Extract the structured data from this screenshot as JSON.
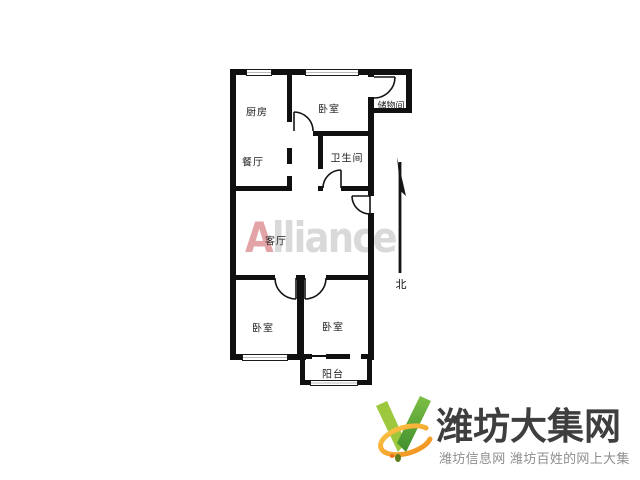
{
  "watermark": {
    "first_letter": "A",
    "rest": "lliance",
    "first_color": "#e3a4a8",
    "rest_color": "#d9d9d9"
  },
  "floorplan": {
    "wall_color": "#101010",
    "rooms": [
      {
        "id": "kitchen",
        "label": "厨房"
      },
      {
        "id": "bedroom-north",
        "label": "卧室"
      },
      {
        "id": "storage",
        "label": "储物间"
      },
      {
        "id": "dining",
        "label": "餐厅"
      },
      {
        "id": "bathroom",
        "label": "卫生间"
      },
      {
        "id": "living-room",
        "label": "客厅"
      },
      {
        "id": "bedroom-southwest",
        "label": "卧室"
      },
      {
        "id": "bedroom-southeast",
        "label": "卧室"
      },
      {
        "id": "balcony",
        "label": "阳台"
      }
    ],
    "compass": {
      "label": "北"
    }
  },
  "logo": {
    "title": "潍坊大集网",
    "tagline": "潍坊信息网 潍坊百姓的网上大集",
    "title_color": "#3e3e3e",
    "tagline_color": "#8e8e8e",
    "mark_colors": {
      "v_left": "#9dc83e",
      "v_right": "#4f9e33",
      "swoosh": "#f6a11f"
    }
  }
}
